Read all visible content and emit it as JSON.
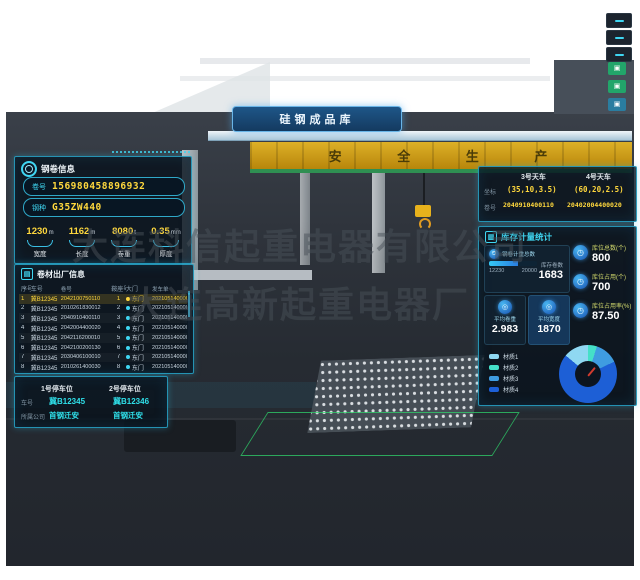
{
  "watermarks": {
    "line1": "大连科信起重电器有限公司",
    "line2": "大连高新起重电器厂"
  },
  "scene": {
    "banner_title": "硅钢成品库",
    "beam_text": "安 全 生 产"
  },
  "coil_info": {
    "title": "钢卷信息",
    "fields": [
      {
        "label": "卷号",
        "value": "156980458896932"
      },
      {
        "label": "钢种",
        "value": "G35ZW440"
      }
    ],
    "stats": [
      {
        "value": "1230",
        "unit": "m",
        "label": "宽度"
      },
      {
        "value": "1162",
        "unit": "m",
        "label": "长度"
      },
      {
        "value": "8080",
        "unit": "t",
        "label": "卷重"
      },
      {
        "value": "0.35",
        "unit": "mm",
        "label": "厚度"
      }
    ]
  },
  "shipment": {
    "title": "卷材出厂信息",
    "columns": [
      "序号",
      "车号",
      "卷号",
      "鞍座号",
      "大门",
      "发车单"
    ],
    "rows": [
      [
        "1",
        "冀B12345",
        "2042100750110",
        "1",
        "东门",
        "2021051400001"
      ],
      [
        "2",
        "冀B12345",
        "2010261830012",
        "2",
        "东门",
        "2021051400001"
      ],
      [
        "3",
        "冀B12345",
        "2040910400110",
        "3",
        "东门",
        "2021051400001"
      ],
      [
        "4",
        "冀B12345",
        "2042004400020",
        "4",
        "东门",
        "2021051400001"
      ],
      [
        "5",
        "冀B12345",
        "2042116200010",
        "5",
        "东门",
        "2021051400001"
      ],
      [
        "6",
        "冀B12345",
        "2042100200130",
        "6",
        "东门",
        "2021051400001"
      ],
      [
        "7",
        "冀B12345",
        "2030406100010",
        "7",
        "东门",
        "2021051400001"
      ],
      [
        "8",
        "冀B12345",
        "2010261400030",
        "8",
        "东门",
        "2021051400001"
      ]
    ]
  },
  "parking": {
    "row_labels": {
      "plate": "车号",
      "company": "所属公司"
    },
    "slots": [
      {
        "title": "1号停车位",
        "plate": "冀B12345",
        "company": "首钢迁安"
      },
      {
        "title": "2号停车位",
        "plate": "冀B12346",
        "company": "首钢迁安"
      }
    ]
  },
  "cranes": {
    "row_labels": {
      "coord": "坐标",
      "coil": "卷号"
    },
    "items": [
      {
        "name": "3号天车",
        "coord": "(35,10,3.5)",
        "coil": "2040910400110"
      },
      {
        "name": "4号天车",
        "coord": "(60,20,2.5)",
        "coil": "20402004400020"
      }
    ]
  },
  "inventory": {
    "title": "库存计量统计",
    "weight_card": {
      "label": "钢卷计重总数",
      "current": "12230",
      "max": "20000",
      "count_label": "库存卷数",
      "count": "1683"
    },
    "avg_cards": [
      {
        "label": "平均卷重",
        "value": "2.983"
      },
      {
        "label": "平均宽度",
        "value": "1870"
      }
    ],
    "slot_stats": [
      {
        "label": "库位总数(个)",
        "value": "800"
      },
      {
        "label": "库位占用(个)",
        "value": "700"
      },
      {
        "label": "库位占用率(%)",
        "value": "87.50"
      }
    ]
  },
  "chart_data": {
    "type": "pie",
    "title": "",
    "categories": [
      "材质1",
      "材质2",
      "材质3",
      "材质4"
    ],
    "values": [
      14,
      5,
      13,
      68
    ],
    "colors": [
      "#8fd8f2",
      "#45e0c8",
      "#3f9ce0",
      "#1d5fd6"
    ],
    "clockwise_order": [
      1,
      2,
      3,
      0
    ],
    "legend_position": "left"
  },
  "colors": {
    "accent_cyan": "#3fd6f2",
    "accent_yellow": "#ffd83d",
    "marker_green": "#22a56a"
  }
}
